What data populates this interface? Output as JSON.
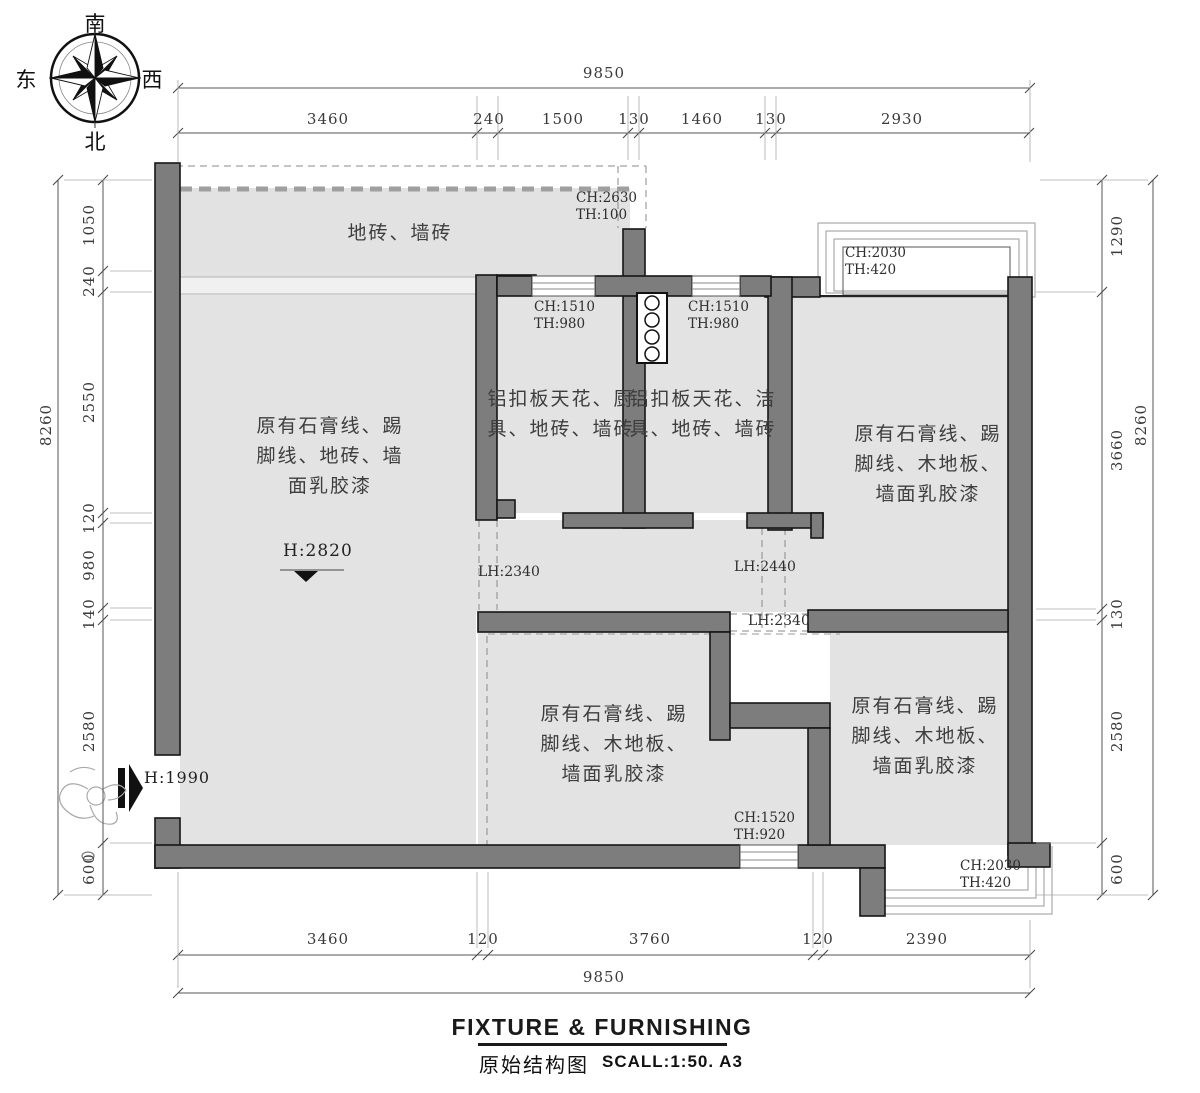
{
  "compass": {
    "south": "南",
    "north": "北",
    "east": "东",
    "west": "西"
  },
  "title": {
    "main": "FIXTURE & FURNISHING",
    "sub": "原始结构图",
    "scale": "SCALL:1:50. A3"
  },
  "rooms": {
    "terrace": {
      "lines": [
        "地砖、墙砖"
      ]
    },
    "living": {
      "lines": [
        "原有石膏线、踢",
        "脚线、地砖、墙",
        "面乳胶漆"
      ]
    },
    "kitchen": {
      "lines": [
        "铝扣板天花、厨",
        "具、地砖、墙砖"
      ]
    },
    "bathroom": {
      "lines": [
        "铝扣板天花、洁",
        "具、地砖、墙砖"
      ]
    },
    "bedroom_top_right": {
      "lines": [
        "原有石膏线、踢",
        "脚线、木地板、",
        "墙面乳胶漆"
      ]
    },
    "bedroom_bottom_middle": {
      "lines": [
        "原有石膏线、踢",
        "脚线、木地板、",
        "墙面乳胶漆"
      ]
    },
    "bedroom_bottom_right": {
      "lines": [
        "原有石膏线、踢",
        "脚线、木地板、",
        "墙面乳胶漆"
      ]
    }
  },
  "annotations": {
    "terrace": [
      "CH:2630",
      "TH:100"
    ],
    "kitchen": [
      "CH:1510",
      "TH:980"
    ],
    "bathroom": [
      "CH:1510",
      "TH:980"
    ],
    "bay_top": [
      "CH:2030",
      "TH:420"
    ],
    "window_bottom": [
      "CH:1520",
      "TH:920"
    ],
    "bay_bottom": [
      "CH:2030",
      "TH:420"
    ],
    "living_height": "H:2820",
    "entry_height": "H:1990",
    "lh_left": "LH:2340",
    "lh_right": "LH:2440",
    "lh_bottom": "LH:2340"
  },
  "dimensions": {
    "top_overall": "9850",
    "top_segments": [
      "3460",
      "240",
      "1500",
      "130",
      "1460",
      "130",
      "2930"
    ],
    "bottom_segments": [
      "3460",
      "120",
      "3760",
      "120",
      "2390"
    ],
    "bottom_overall": "9850",
    "left_overall": "8260",
    "left_segments": [
      "1050",
      "240",
      "2550",
      "120",
      "980",
      "140",
      "2580",
      "600"
    ],
    "right_segments": [
      "1290",
      "3660",
      "130",
      "2580",
      "600"
    ],
    "right_overall": "8260"
  },
  "colors": {
    "wall": "#7d7d7d",
    "room_fill": "#e3e3e3",
    "dim_line": "#555555"
  }
}
